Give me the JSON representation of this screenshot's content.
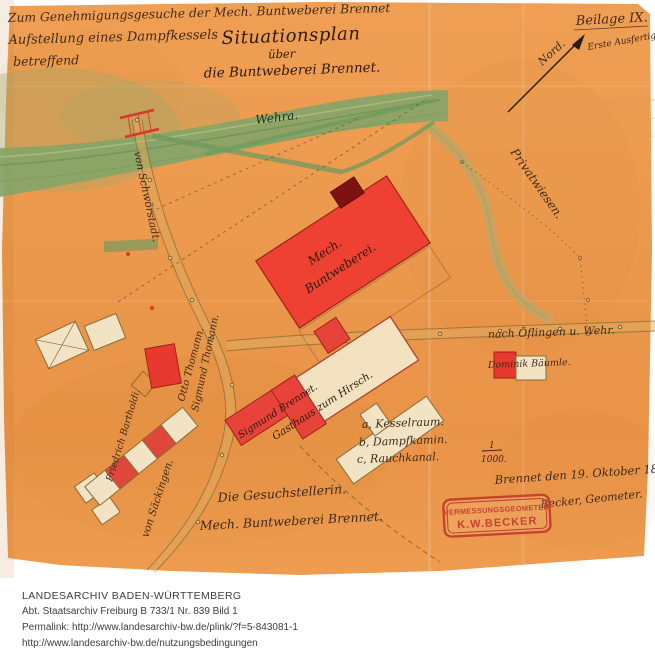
{
  "header": {
    "request_line1": "Zum Genehmigungsgesuche der Mech. Buntweberei Brennet",
    "request_line2": "Aufstellung eines Dampfkessels",
    "request_line3": "betreffend",
    "title": "Situationsplan",
    "title_sub": "über",
    "title_sub2": "die Buntweberei Brennet.",
    "annex": "Beilage IX.",
    "north": "Nord.",
    "copy_note": "Erste Ausfertigung."
  },
  "map": {
    "river": "Wehra.",
    "road_left": "von Schwörstadt.",
    "road_bottom": "von Säckingen.",
    "road_right": "nach Öflingen u. Wehr.",
    "meadow": "Privatwiesen.",
    "factory_line1": "Mech.",
    "factory_line2": "Buntweberei.",
    "owner_road": "Sigmund Thomann.",
    "owner_otto": "Otto Thomann.",
    "inn_line1": "Sigmund Brennet.",
    "inn_line2": "Gasthaus zum Hirsch.",
    "owner_row": "Friedrich Bartholdi.",
    "owner_baeumle": "Dominik Bäumle."
  },
  "legend": {
    "line1": "a, Kesselraum.",
    "line2": "b, Dampfkamin.",
    "line3": "c, Rauchkanal.",
    "scale_num": "1",
    "scale_den": "1000."
  },
  "certification": {
    "date_line": "Brennet den 19. Oktober 1882.",
    "signature": "Becker, Geometer.",
    "stamp_line1": "VERMESSUNGSGEOMETER",
    "stamp_line2": "K.W.BECKER",
    "applicant_line1": "Die Gesuchstellerin.",
    "applicant_line2": "Mech. Buntweberei Brennet."
  },
  "footer": {
    "archive": "LANDESARCHIV BADEN-WÜRTTEMBERG",
    "reference": "Abt. Staatsarchiv Freiburg B 733/1 Nr. 839 Bild 1",
    "permalink": "Permalink: http://www.landesarchiv-bw.de/plink/?f=5-843081-1",
    "terms": "http://www.landesarchiv-bw.de/nutzungsbedingungen"
  },
  "colors": {
    "paper": "#ec9a4f",
    "river_green": "#85a061",
    "building_red": "#e8392e",
    "ink": "#42291a",
    "stamp_red": "#c23a2c"
  }
}
